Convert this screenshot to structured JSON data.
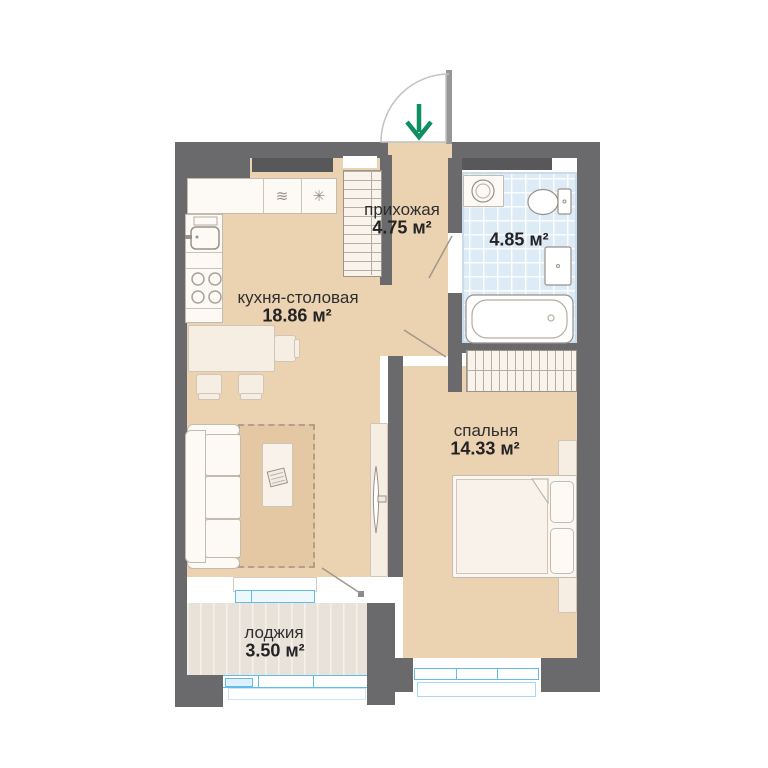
{
  "plan_title": "apartment-floor-plan",
  "rooms": {
    "hallway": {
      "label": "прихожая",
      "area": "4.75 м²"
    },
    "bathroom": {
      "area": "4.85 м²"
    },
    "kitchen_living": {
      "label": "кухня-столовая",
      "area": "18.86 м²"
    },
    "bedroom": {
      "label": "спальня",
      "area": "14.33 м²"
    },
    "loggia": {
      "label": "лоджия",
      "area": "3.50 м²"
    }
  },
  "appliances": {
    "dishwasher_glyph": "≋",
    "fridge_glyph": "✳"
  },
  "entry": {
    "direction": "down"
  },
  "colors": {
    "wall": "#6a6a6d",
    "floor": "#ebd2b1",
    "bathroom_tile": "#ddebf6",
    "loggia_floor": "#e9e2d9",
    "window_blue": "#62bce8",
    "entry_arrow_green": "#0e8e62",
    "furniture_outline": "#b5aca1"
  }
}
